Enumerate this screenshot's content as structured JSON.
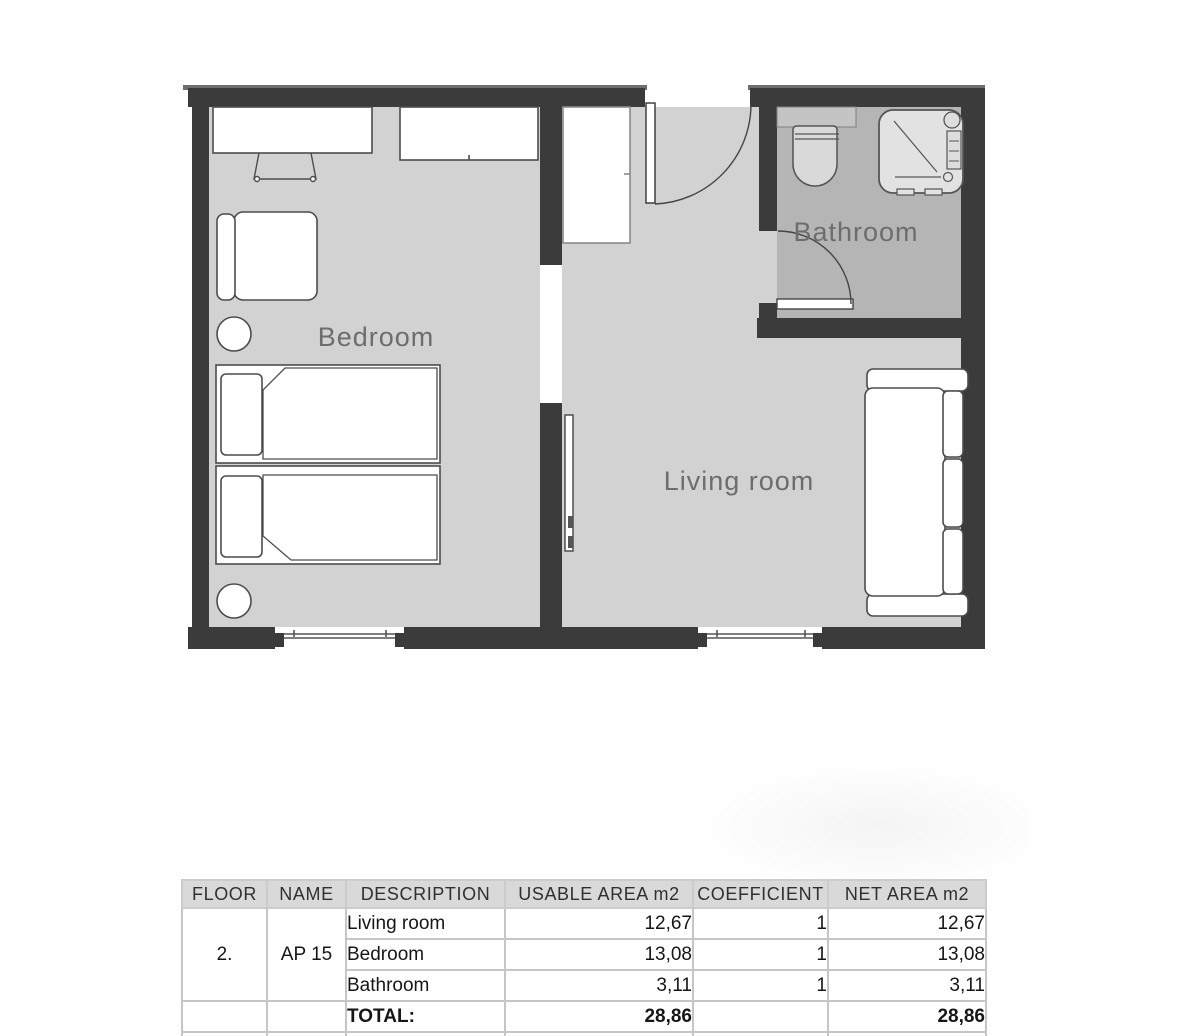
{
  "plan": {
    "rooms": [
      {
        "label": "Bedroom"
      },
      {
        "label": "Living room"
      },
      {
        "label": "Bathroom"
      }
    ],
    "colors": {
      "wall": "#3b3b3b",
      "wall_edge": "#6e6e6e",
      "floor": "#d2d2d2",
      "bathroom_floor": "#b5b5b5",
      "furniture_line": "#4c4c4c",
      "label_text": "#6d6d6d"
    }
  },
  "table": {
    "headers": [
      "FLOOR",
      "NAME",
      "DESCRIPTION",
      "USABLE AREA m2",
      "COEFFICIENT",
      "NET AREA m2"
    ],
    "floor_value": "2.",
    "name_value": "AP 15",
    "rows": [
      {
        "description": "Living room",
        "usable": "12,67",
        "coefficient": "1",
        "net": "12,67"
      },
      {
        "description": "Bedroom",
        "usable": "13,08",
        "coefficient": "1",
        "net": "13,08"
      },
      {
        "description": "Bathroom",
        "usable": "3,11",
        "coefficient": "1",
        "net": "3,11"
      }
    ],
    "total": {
      "label": "TOTAL:",
      "usable": "28,86",
      "net": "28,86"
    }
  }
}
